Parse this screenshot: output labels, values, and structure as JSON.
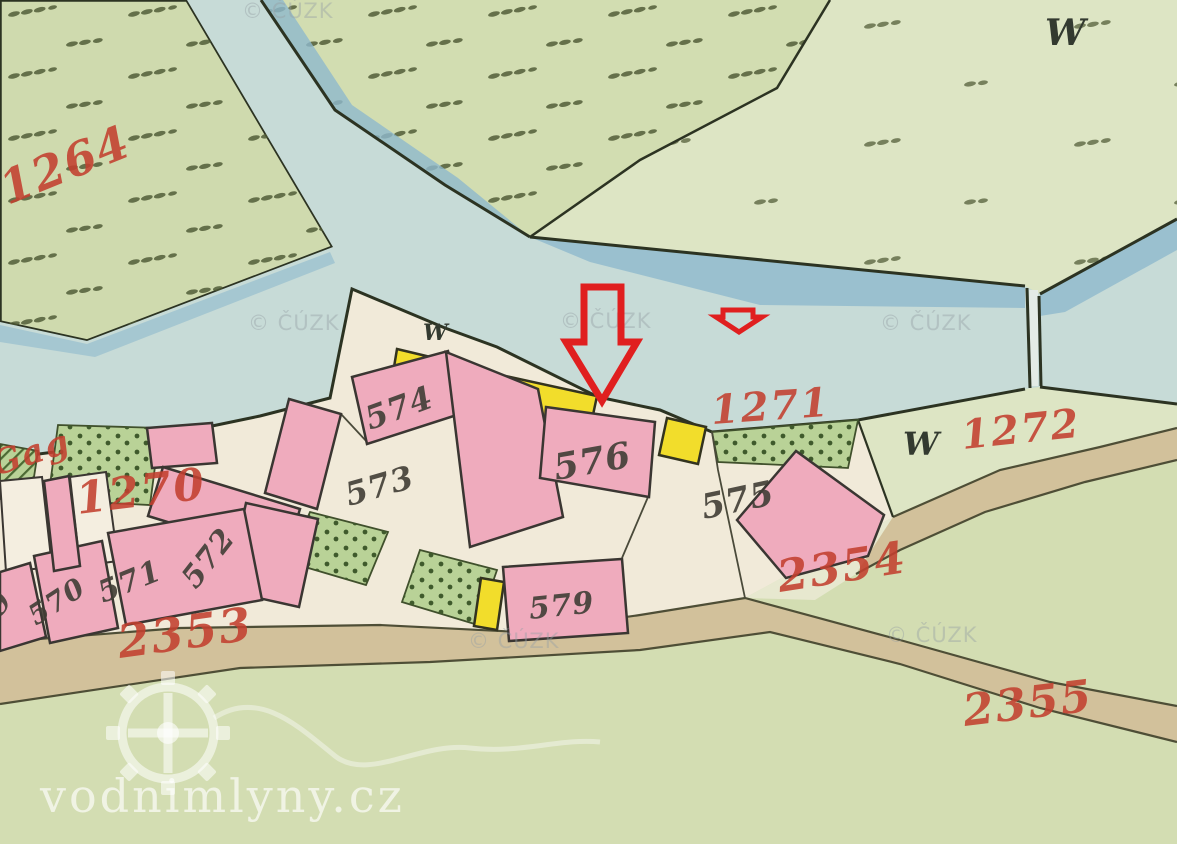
{
  "title": "Historic cadastral map detail",
  "colors": {
    "meadow": "#d3ddb2",
    "meadow_light": "#dde5c4",
    "river": "#c7dbd7",
    "river_shadow": "#8eb9cd",
    "village_ground": "#f1ead9",
    "road": "#d2c19b",
    "masonry_building": "#efabbd",
    "wooden_building": "#f2dd2b",
    "garden": "#b9d297",
    "label_red": "#c3402f",
    "label_dark": "#413e36",
    "arrow": "#e01f1f"
  },
  "watermarks": {
    "cuzk": "© ČÚZK",
    "site": "vodnimlyny.cz"
  },
  "icons": {
    "large_arrow": "down-arrow",
    "small_arrow": "down-arrow-small",
    "logo": "mill-wheel"
  },
  "parcel_labels": [
    {
      "text": "1264"
    },
    {
      "text": "Gag"
    },
    {
      "text": "1270"
    },
    {
      "text": "1271"
    },
    {
      "text": "1272"
    },
    {
      "text": "2353"
    },
    {
      "text": "2354"
    },
    {
      "text": "2355"
    }
  ],
  "building_labels": [
    {
      "text": "569"
    },
    {
      "text": "570"
    },
    {
      "text": "571"
    },
    {
      "text": "572"
    },
    {
      "text": "573"
    },
    {
      "text": "574"
    },
    {
      "text": "575"
    },
    {
      "text": "576"
    },
    {
      "text": "579"
    }
  ],
  "meadow_mark": "W"
}
